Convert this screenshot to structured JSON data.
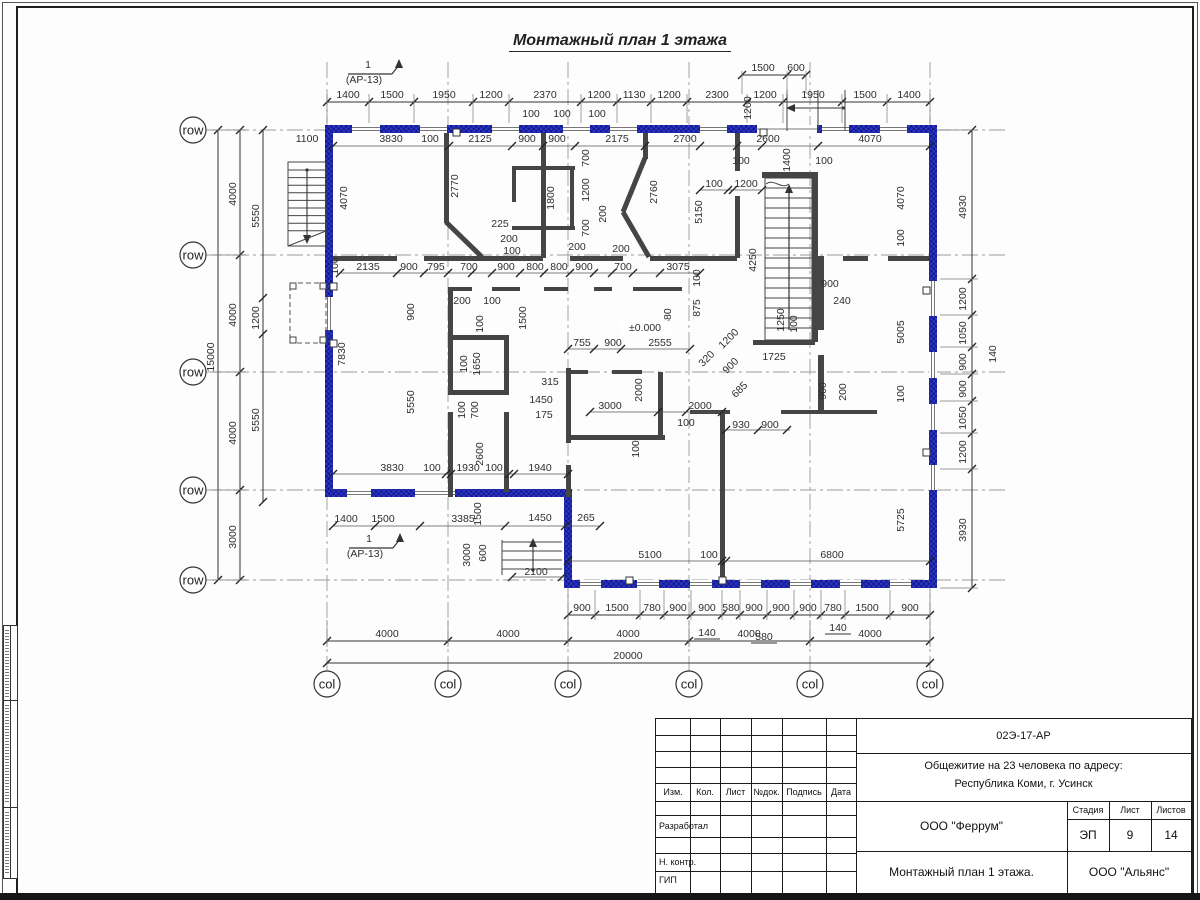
{
  "sheet": {
    "title": "Монтажный план 1 этажа"
  },
  "marks": {
    "section_num": "1",
    "section_ref": "(АР-13)",
    "level": "±0.000"
  },
  "axes": {
    "rows": [
      {
        "name": "Д",
        "y": 130
      },
      {
        "name": "Г",
        "y": 255
      },
      {
        "name": "В",
        "y": 372
      },
      {
        "name": "Б",
        "y": 490
      },
      {
        "name": "А",
        "y": 580
      }
    ],
    "cols": [
      {
        "name": "1",
        "x": 327
      },
      {
        "name": "2",
        "x": 448
      },
      {
        "name": "3",
        "x": 568
      },
      {
        "name": "4",
        "x": 689
      },
      {
        "name": "5",
        "x": 810
      },
      {
        "name": "6",
        "x": 930
      }
    ]
  },
  "dims": {
    "chains": [
      {
        "o": "h",
        "line": 102,
        "from": 327,
        "to": 930,
        "ticks": [
          327,
          369,
          414,
          473,
          509,
          581,
          617,
          651,
          687,
          747,
          783,
          842,
          887,
          930
        ],
        "ext": [
          123,
          94
        ]
      },
      {
        "o": "h",
        "line": 75,
        "from": 742,
        "to": 806,
        "ticks": [
          742,
          787,
          806
        ],
        "ext": [
          94,
          71
        ]
      },
      {
        "o": "h",
        "line": 615,
        "from": 568,
        "to": 930,
        "ticks": [
          568,
          595,
          640,
          664,
          691,
          722,
          740,
          767,
          794,
          821,
          845,
          890,
          930
        ],
        "ext": [
          590,
          620
        ]
      },
      {
        "o": "h",
        "line": 641,
        "from": 327,
        "to": 930,
        "ticks": [
          327,
          448,
          568,
          689,
          810,
          930
        ],
        "ext": [
          620,
          647
        ]
      },
      {
        "o": "h",
        "line": 663,
        "from": 327,
        "to": 930,
        "ticks": [
          327,
          930
        ]
      },
      {
        "o": "v",
        "line": 218,
        "from": 130,
        "to": 580,
        "ticks": [
          130,
          580
        ]
      },
      {
        "o": "v",
        "line": 240,
        "from": 130,
        "to": 580,
        "ticks": [
          130,
          255,
          372,
          490,
          580
        ],
        "ext": [
          212,
          246
        ]
      },
      {
        "o": "v",
        "line": 263,
        "from": 130,
        "to": 502,
        "ticks": [
          130,
          298,
          334,
          502
        ]
      },
      {
        "o": "v",
        "line": 972,
        "from": 130,
        "to": 588,
        "ticks": [
          130,
          279,
          315,
          347,
          374,
          401,
          433,
          469,
          588
        ],
        "ext": [
          940,
          978
        ]
      },
      {
        "o": "h",
        "line": 146,
        "from": 333,
        "to": 930,
        "ticks": [
          333,
          449,
          512,
          543,
          575,
          645,
          700,
          737,
          762,
          818,
          930
        ],
        "light": 1
      },
      {
        "o": "h",
        "line": 273,
        "from": 340,
        "to": 700,
        "ticks": [
          340,
          397,
          424,
          448,
          472,
          492,
          520,
          544,
          570,
          594,
          612,
          633,
          660,
          700
        ],
        "light": 1
      },
      {
        "o": "h",
        "line": 349,
        "from": 568,
        "to": 690,
        "ticks": [
          568,
          594,
          621,
          690
        ],
        "light": 1
      },
      {
        "o": "h",
        "line": 412,
        "from": 590,
        "to": 722,
        "ticks": [
          590,
          658,
          686,
          722
        ],
        "light": 1
      },
      {
        "o": "h",
        "line": 430,
        "from": 726,
        "to": 790,
        "ticks": [
          726,
          758,
          787
        ],
        "light": 1
      },
      {
        "o": "h",
        "line": 474,
        "from": 333,
        "to": 568,
        "ticks": [
          333,
          446,
          451,
          509,
          514,
          568
        ],
        "light": 1
      },
      {
        "o": "h",
        "line": 526,
        "from": 333,
        "to": 600,
        "ticks": [
          333,
          375,
          420,
          505,
          565,
          600
        ],
        "light": 1
      },
      {
        "o": "h",
        "line": 561,
        "from": 568,
        "to": 930,
        "ticks": [
          568,
          722,
          726,
          930
        ],
        "light": 1
      },
      {
        "o": "h",
        "line": 577,
        "from": 512,
        "to": 565,
        "ticks": [
          512,
          562
        ],
        "light": 1
      },
      {
        "o": "h",
        "line": 190,
        "from": 700,
        "to": 762,
        "ticks": [
          700,
          728,
          733,
          762
        ],
        "light": 1
      }
    ],
    "labels": [
      [
        1400,
        348,
        98,
        0
      ],
      [
        1500,
        392,
        98,
        0
      ],
      [
        1950,
        444,
        98,
        0
      ],
      [
        1200,
        491,
        98,
        0
      ],
      [
        2370,
        545,
        98,
        0
      ],
      [
        1200,
        599,
        98,
        0
      ],
      [
        1130,
        634,
        98,
        0
      ],
      [
        1200,
        669,
        98,
        0
      ],
      [
        2300,
        717,
        98,
        0
      ],
      [
        1200,
        765,
        98,
        0
      ],
      [
        1950,
        813,
        98,
        0
      ],
      [
        1500,
        865,
        98,
        0
      ],
      [
        1400,
        909,
        98,
        0
      ],
      [
        1500,
        763,
        71,
        0
      ],
      [
        600,
        796,
        71,
        0
      ],
      [
        100,
        531,
        117,
        0
      ],
      [
        100,
        562,
        117,
        0
      ],
      [
        100,
        597,
        117,
        0
      ],
      [
        1200,
        751,
        108,
        1
      ],
      [
        1100,
        307,
        142,
        0
      ],
      [
        3830,
        391,
        142,
        0
      ],
      [
        100,
        430,
        142,
        0
      ],
      [
        2125,
        480,
        142,
        0
      ],
      [
        900,
        527,
        142,
        0
      ],
      [
        900,
        557,
        142,
        0
      ],
      [
        2175,
        617,
        142,
        0
      ],
      [
        2700,
        685,
        142,
        0
      ],
      [
        2600,
        768,
        142,
        0
      ],
      [
        4070,
        870,
        142,
        0
      ],
      [
        1400,
        790,
        160,
        1
      ],
      [
        100,
        714,
        187,
        0
      ],
      [
        1200,
        746,
        187,
        0
      ],
      [
        100,
        741,
        164,
        0
      ],
      [
        100,
        824,
        164,
        0
      ],
      [
        4070,
        347,
        198,
        1
      ],
      [
        2770,
        458,
        186,
        1
      ],
      [
        1800,
        554,
        198,
        1
      ],
      [
        700,
        589,
        158,
        1
      ],
      [
        1200,
        589,
        190,
        1
      ],
      [
        700,
        589,
        228,
        1
      ],
      [
        200,
        606,
        214,
        1
      ],
      [
        2760,
        657,
        192,
        1
      ],
      [
        5150,
        702,
        212,
        1
      ],
      [
        4250,
        756,
        260,
        1
      ],
      [
        4070,
        904,
        198,
        1
      ],
      [
        100,
        904,
        238,
        1
      ],
      [
        225,
        500,
        227,
        0
      ],
      [
        200,
        509,
        242,
        0
      ],
      [
        100,
        512,
        254,
        0
      ],
      [
        200,
        577,
        250,
        0
      ],
      [
        200,
        621,
        252,
        0
      ],
      [
        2135,
        368,
        270,
        0
      ],
      [
        900,
        409,
        270,
        0
      ],
      [
        795,
        436,
        270,
        0
      ],
      [
        700,
        469,
        270,
        0
      ],
      [
        900,
        506,
        270,
        0
      ],
      [
        800,
        535,
        270,
        0
      ],
      [
        800,
        559,
        270,
        0
      ],
      [
        900,
        584,
        270,
        0
      ],
      [
        700,
        623,
        270,
        0
      ],
      [
        3075,
        678,
        270,
        0
      ],
      [
        100,
        338,
        266,
        1
      ],
      [
        100,
        700,
        278,
        1
      ],
      [
        875,
        700,
        308,
        1
      ],
      [
        200,
        462,
        304,
        0
      ],
      [
        100,
        492,
        304,
        0
      ],
      [
        900,
        830,
        287,
        0
      ],
      [
        240,
        842,
        304,
        0
      ],
      [
        755,
        582,
        346,
        0
      ],
      [
        900,
        613,
        346,
        0
      ],
      [
        2555,
        660,
        346,
        0
      ],
      [
        2580,
        671,
        320,
        1
      ],
      [
        "±0.000",
        645,
        331,
        3
      ],
      [
        1200,
        731,
        341,
        2
      ],
      [
        320,
        709,
        361,
        2
      ],
      [
        900,
        733,
        368,
        2
      ],
      [
        685,
        742,
        392,
        2
      ],
      [
        1250,
        784,
        320,
        1
      ],
      [
        100,
        797,
        324,
        1
      ],
      [
        1725,
        774,
        360,
        0
      ],
      [
        900,
        414,
        312,
        1
      ],
      [
        1500,
        526,
        318,
        1
      ],
      [
        100,
        483,
        324,
        1
      ],
      [
        1650,
        480,
        364,
        1
      ],
      [
        100,
        467,
        364,
        1
      ],
      [
        100,
        465,
        410,
        1
      ],
      [
        700,
        478,
        410,
        1
      ],
      [
        315,
        550,
        385,
        0
      ],
      [
        1450,
        541,
        403,
        0
      ],
      [
        175,
        544,
        418,
        0
      ],
      [
        3000,
        610,
        409,
        0
      ],
      [
        2000,
        700,
        409,
        0
      ],
      [
        2000,
        642,
        390,
        1
      ],
      [
        100,
        686,
        426,
        0
      ],
      [
        100,
        639,
        449,
        1
      ],
      [
        930,
        741,
        428,
        0
      ],
      [
        900,
        770,
        428,
        0
      ],
      [
        900,
        826,
        391,
        1
      ],
      [
        200,
        846,
        392,
        1
      ],
      [
        5005,
        904,
        332,
        1
      ],
      [
        100,
        904,
        394,
        1
      ],
      [
        5725,
        904,
        520,
        1
      ],
      [
        5550,
        414,
        402,
        1
      ],
      [
        2600,
        483,
        454,
        1
      ],
      [
        7830,
        345,
        354,
        1
      ],
      [
        3830,
        392,
        471,
        0
      ],
      [
        100,
        432,
        471,
        0
      ],
      [
        1930,
        468,
        471,
        0
      ],
      [
        100,
        494,
        471,
        0
      ],
      [
        1940,
        540,
        471,
        0
      ],
      [
        1400,
        346,
        522,
        0
      ],
      [
        1500,
        383,
        522,
        0
      ],
      [
        3385,
        463,
        522,
        0
      ],
      [
        1450,
        540,
        521,
        0
      ],
      [
        265,
        586,
        521,
        0
      ],
      [
        1500,
        481,
        514,
        1
      ],
      [
        3000,
        470,
        555,
        1
      ],
      [
        600,
        486,
        553,
        1
      ],
      [
        2100,
        536,
        575,
        0
      ],
      [
        5100,
        650,
        558,
        0
      ],
      [
        100,
        709,
        558,
        0
      ],
      [
        6800,
        832,
        558,
        0
      ],
      [
        15000,
        214,
        357,
        1
      ],
      [
        4000,
        236,
        194,
        1
      ],
      [
        4000,
        236,
        315,
        1
      ],
      [
        4000,
        236,
        433,
        1
      ],
      [
        3000,
        236,
        537,
        1
      ],
      [
        5550,
        259,
        216,
        1
      ],
      [
        1200,
        259,
        318,
        1
      ],
      [
        5550,
        259,
        420,
        1
      ],
      [
        4930,
        966,
        207,
        1
      ],
      [
        1200,
        966,
        299,
        1
      ],
      [
        1050,
        966,
        333,
        1
      ],
      [
        900,
        966,
        362,
        1
      ],
      [
        140,
        996,
        354,
        1
      ],
      [
        900,
        966,
        389,
        1
      ],
      [
        1050,
        966,
        418,
        1
      ],
      [
        1200,
        966,
        452,
        1
      ],
      [
        3930,
        966,
        530,
        1
      ],
      [
        900,
        582,
        611,
        0
      ],
      [
        1500,
        617,
        611,
        0
      ],
      [
        780,
        652,
        611,
        0
      ],
      [
        900,
        678,
        611,
        0
      ],
      [
        900,
        707,
        611,
        0
      ],
      [
        580,
        731,
        611,
        0
      ],
      [
        900,
        754,
        611,
        0
      ],
      [
        900,
        781,
        611,
        0
      ],
      [
        900,
        808,
        611,
        0
      ],
      [
        780,
        833,
        611,
        0
      ],
      [
        1500,
        867,
        611,
        0
      ],
      [
        900,
        910,
        611,
        0
      ],
      [
        140,
        707,
        636,
        4
      ],
      [
        580,
        764,
        640,
        4
      ],
      [
        140,
        838,
        631,
        4
      ],
      [
        4000,
        387,
        637,
        0
      ],
      [
        4000,
        508,
        637,
        0
      ],
      [
        4000,
        628,
        637,
        0
      ],
      [
        4000,
        749,
        637,
        0
      ],
      [
        4000,
        870,
        637,
        0
      ],
      [
        20000,
        628,
        659,
        0
      ],
      [
        "1",
        368,
        68,
        0
      ],
      [
        "(АР-13)",
        364,
        83,
        0
      ],
      [
        "1",
        369,
        542,
        0
      ],
      [
        "(АР-13)",
        365,
        557,
        0
      ]
    ]
  },
  "title_block": {
    "code": "02Э-17-АР",
    "project_line1": "Общежитие на 23 человека по адресу:",
    "project_line2": "Республика Коми, г. Усинск",
    "cols": [
      "Изм.",
      "Кол.",
      "Лист",
      "№док.",
      "Подпись",
      "Дата"
    ],
    "rows": [
      "Разработал",
      "Н. контр.",
      "ГИП"
    ],
    "org": "ООО \"Феррум\"",
    "stage_label": "Стадия",
    "sheet_label": "Лист",
    "sheets_label": "Листов",
    "stage": "ЭП",
    "sheet": "9",
    "sheets": "14",
    "drawing": "Монтажный план 1 этажа.",
    "company": "ООО \"Альянс\""
  },
  "colors": {
    "exterior_wall": "#2c35c4",
    "exterior_wall_dark": "#141b8f",
    "interior_wall": "#454545",
    "line": "#333333",
    "axis": "#9a9a9a",
    "text": "#2e2e2e"
  }
}
